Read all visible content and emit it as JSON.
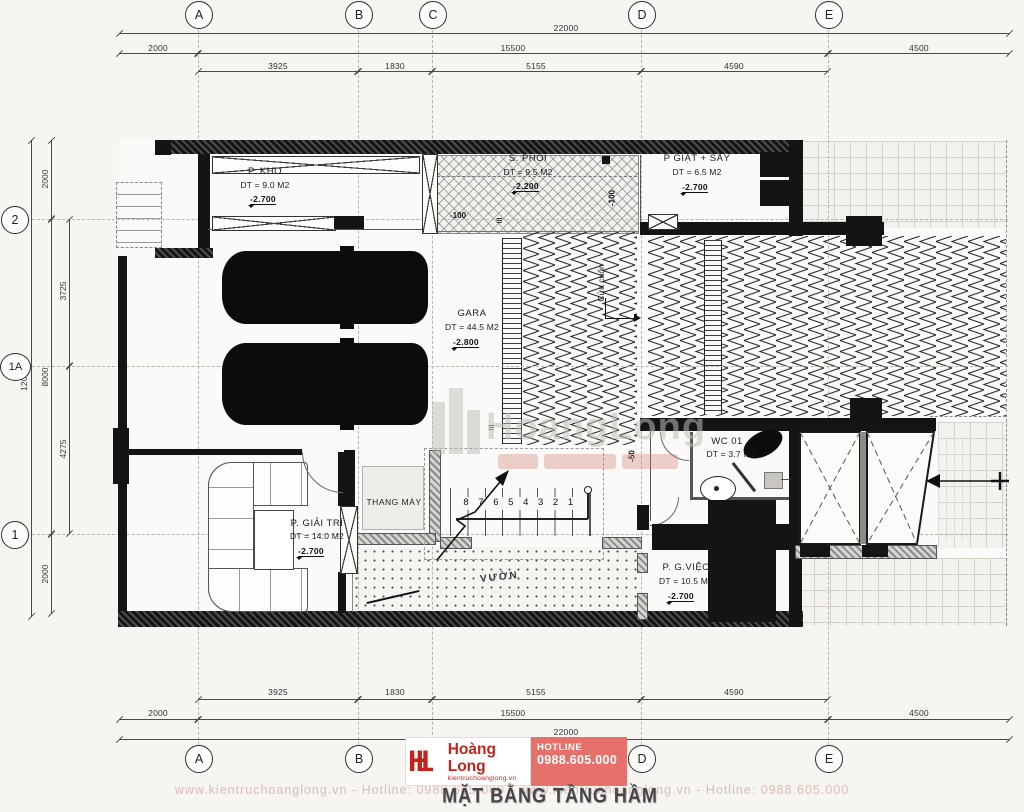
{
  "brand": {
    "monogram": "HL",
    "name": "Hoàng Long",
    "website": "kientruchoanglong.vn",
    "hotline_label": "HOTLINE",
    "hotline_number": "0988.605.000"
  },
  "drawing": {
    "title": "MẶT BẰNG TẦNG HẦM"
  },
  "grid": {
    "cols": [
      "A",
      "B",
      "C",
      "D",
      "E"
    ],
    "rows": [
      "2",
      "1A",
      "1"
    ]
  },
  "dims": {
    "total_h": "22000",
    "mid_h": [
      "2000",
      "15500",
      "4500"
    ],
    "inner_h": [
      "3925",
      "1830",
      "5155",
      "4590"
    ],
    "total_v": "12000",
    "mid_v": [
      "2000",
      "8000",
      "2000"
    ],
    "inner_v": [
      "3725",
      "4275"
    ]
  },
  "rooms": {
    "kho": {
      "name": "P. KHO",
      "area": "DT = 9.0 M2",
      "level": "-2.700"
    },
    "phoi": {
      "name": "S. PHOI",
      "area": "DT = 9.5 M2",
      "level": "-2.200"
    },
    "giat": {
      "name": "P GIẶT + SẤY",
      "area": "DT = 6.5 M2",
      "level": "-2.700"
    },
    "gara": {
      "name": "GARA",
      "area": "DT = 44.5 M2",
      "level": "-2.800"
    },
    "wc": {
      "name": "WC 01",
      "area": "DT = 3.7 M2"
    },
    "thangmay": {
      "name": "THANG MÁY"
    },
    "giaitri": {
      "name": "P. GIẢI TRÍ",
      "area": "DT = 14.0 M2",
      "level": "-2.700"
    },
    "gviec": {
      "name": "P. G.VIỆC",
      "area": "DT = 10.5 M2",
      "level": "-2.700"
    },
    "vuon": {
      "name": "VƯỜN"
    }
  },
  "ann": {
    "cua_cuon": "Cửa cuốn",
    "stairs": "8 7 6 5 4 3 2 1",
    "m100": "-100",
    "m50": "-50",
    "tri": "≡"
  },
  "wm": {
    "big": "HoangLong",
    "line": "www.kientruchoanglong.vn  -  Hotline: 0988.605.000  -  www.kientruchoanglong.vn  -  Hotline: 0988.605.000"
  }
}
